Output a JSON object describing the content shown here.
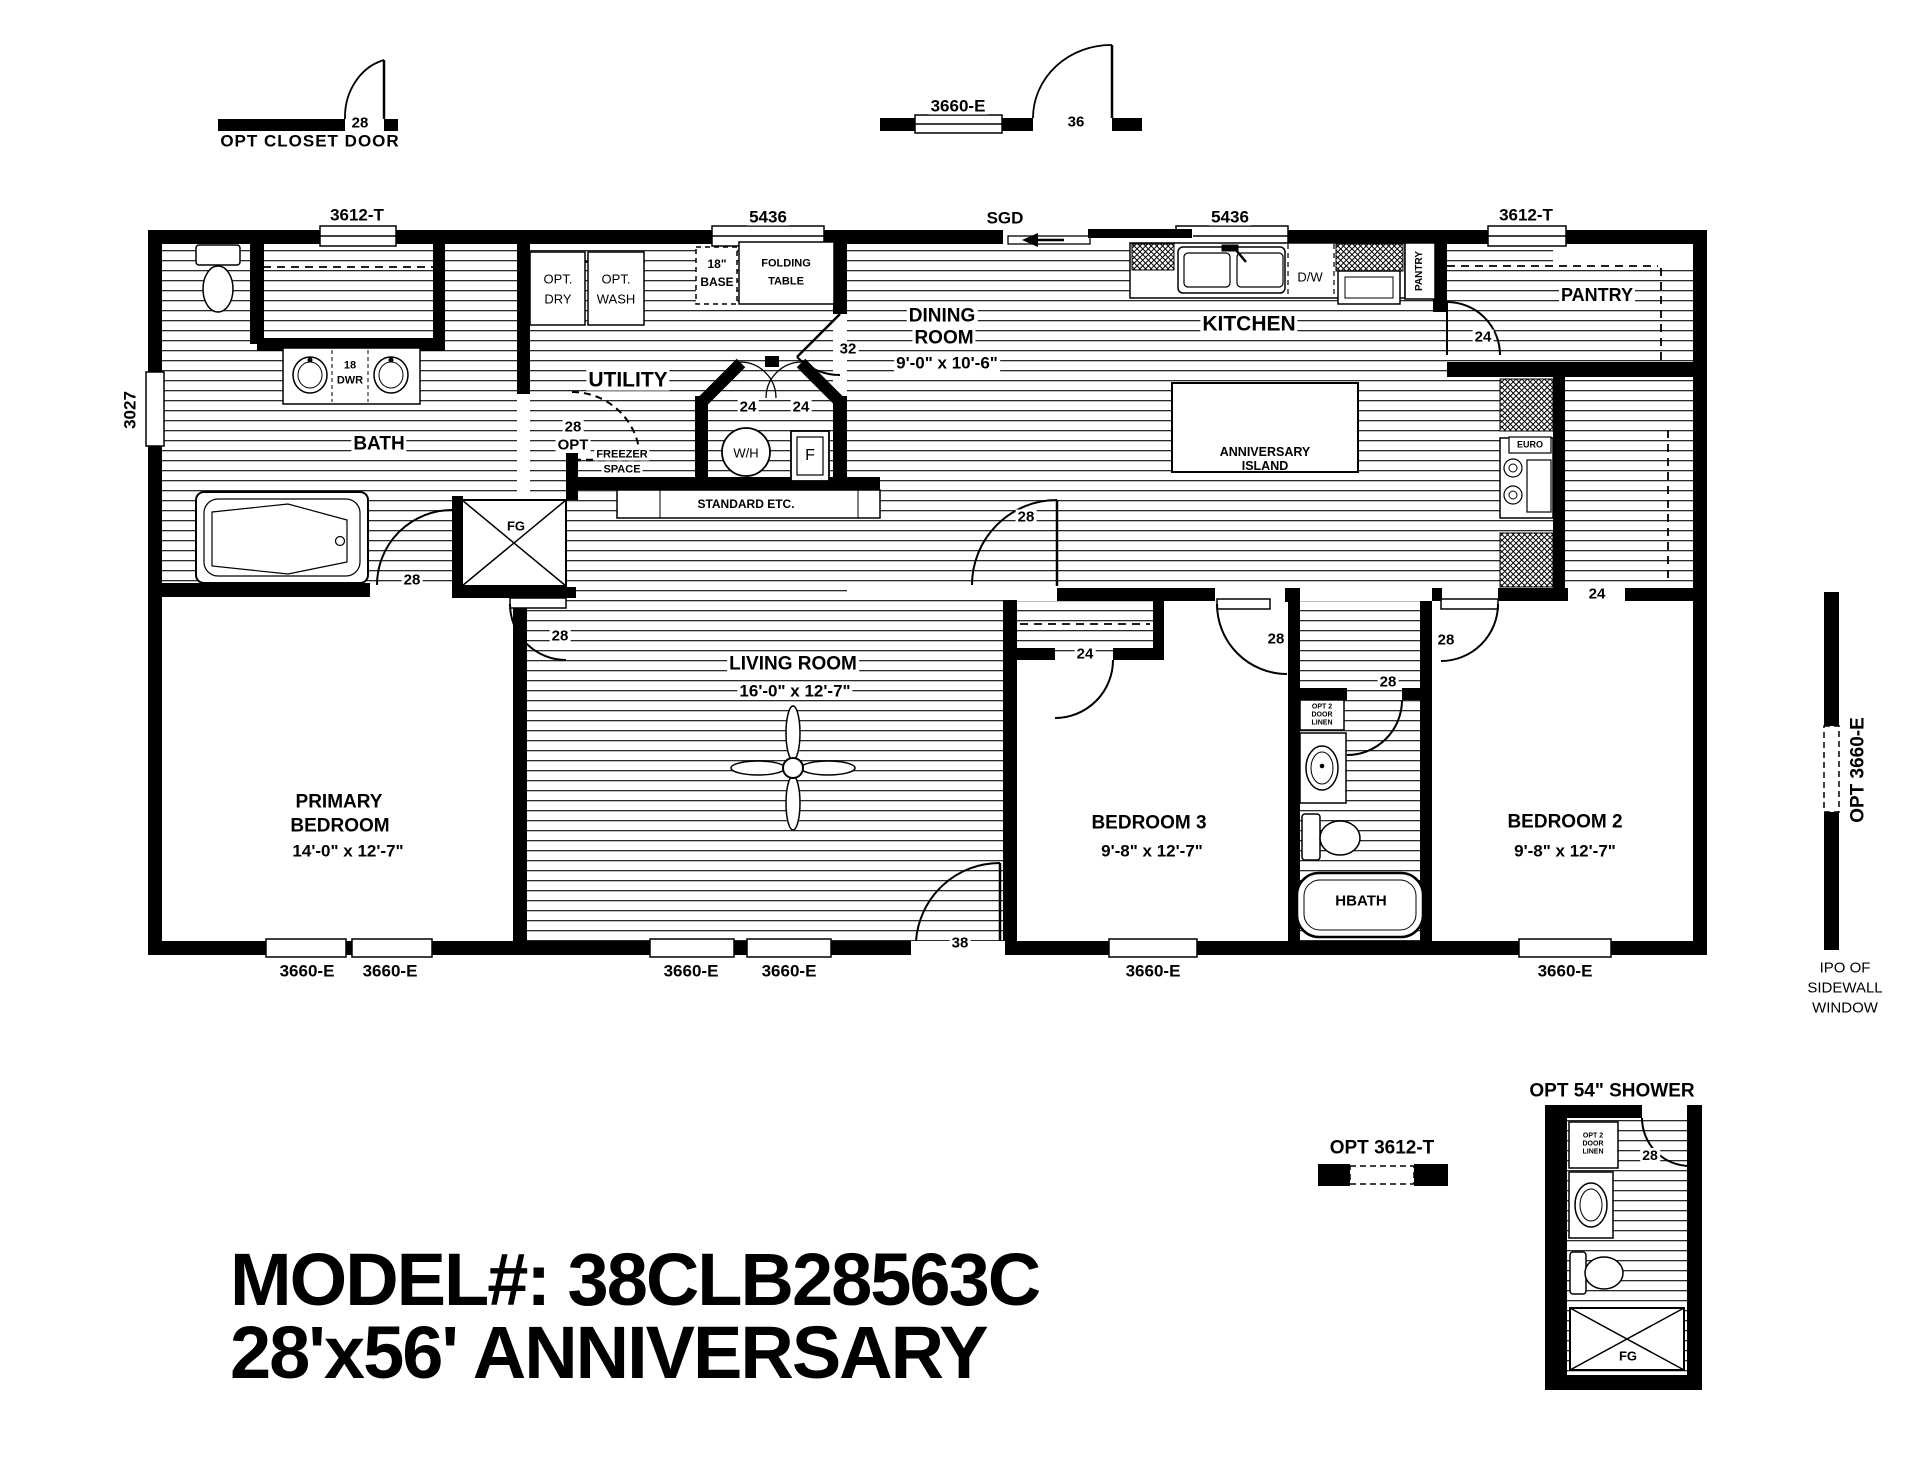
{
  "legend": {
    "closet_door": "OPT CLOSET DOOR",
    "closet_size": "28",
    "window": "3660-E",
    "door_size": "36"
  },
  "windows": {
    "top": [
      "3612-T",
      "5436",
      "5436",
      "3612-T"
    ],
    "sgd": "SGD",
    "left": "3027",
    "bottom": [
      "3660-E",
      "3660-E",
      "3660-E",
      "3660-E",
      "3660-E",
      "3660-E"
    ],
    "sidewall_opt": "OPT 3660-E",
    "sidewall_note": [
      "IPO OF",
      "SIDEWALL",
      "WINDOW"
    ],
    "opt_3612": "OPT 3612-T"
  },
  "rooms": {
    "bath": "BATH",
    "utility": "UTILITY",
    "dining": [
      "DINING",
      "ROOM"
    ],
    "dining_dims": "9'-0\" x  10'-6\"",
    "kitchen": "KITCHEN",
    "pantry": "PANTRY",
    "living": "LIVING ROOM",
    "living_dims": "16'-0\" x  12'-7\"",
    "primary": [
      "PRIMARY",
      "BEDROOM"
    ],
    "primary_dims": "14'-0\" x  12'-7\"",
    "bed3": "BEDROOM 3",
    "bed3_dims": "9'-8\" x  12'-7\"",
    "bed2": "BEDROOM 2",
    "bed2_dims": "9'-8\" x  12'-7\"",
    "hbath": "HBATH"
  },
  "doors": {
    "bath": "28",
    "bath_opt": [
      "28",
      "OPT"
    ],
    "primary": "28",
    "hall": "28",
    "entry": "38",
    "utility": "32",
    "wh": [
      "24",
      "24"
    ],
    "b3_closet": "24",
    "b3": "28",
    "hbath": "28",
    "b2": "28",
    "b2_closet": "24",
    "pantry": "24",
    "shower": "28"
  },
  "fixtures": {
    "wh": "W/H",
    "furnace": "F",
    "fg": "FG",
    "fg2": "FG",
    "euro": "EURO",
    "dw": "D/W",
    "pantry_cab": "PANTRY",
    "dwr": [
      "18",
      "DWR"
    ],
    "base": [
      "18\"",
      "BASE"
    ],
    "folding": [
      "FOLDING",
      "TABLE"
    ],
    "freezer": [
      "FREEZER",
      "SPACE"
    ],
    "standard": "STANDARD ETC.",
    "island": [
      "ANNIVERSARY",
      "ISLAND"
    ],
    "dry": [
      "OPT.",
      "DRY"
    ],
    "wash": [
      "OPT.",
      "WASH"
    ],
    "linen": [
      "OPT 2",
      "DOOR",
      "LINEN"
    ],
    "linen2": [
      "OPT 2",
      "DOOR",
      "LINEN"
    ]
  },
  "titles": {
    "shower": "OPT  54\" SHOWER",
    "model1": "MODEL#: 38CLB28563C",
    "model2": "28'x56'  ANNIVERSARY"
  }
}
